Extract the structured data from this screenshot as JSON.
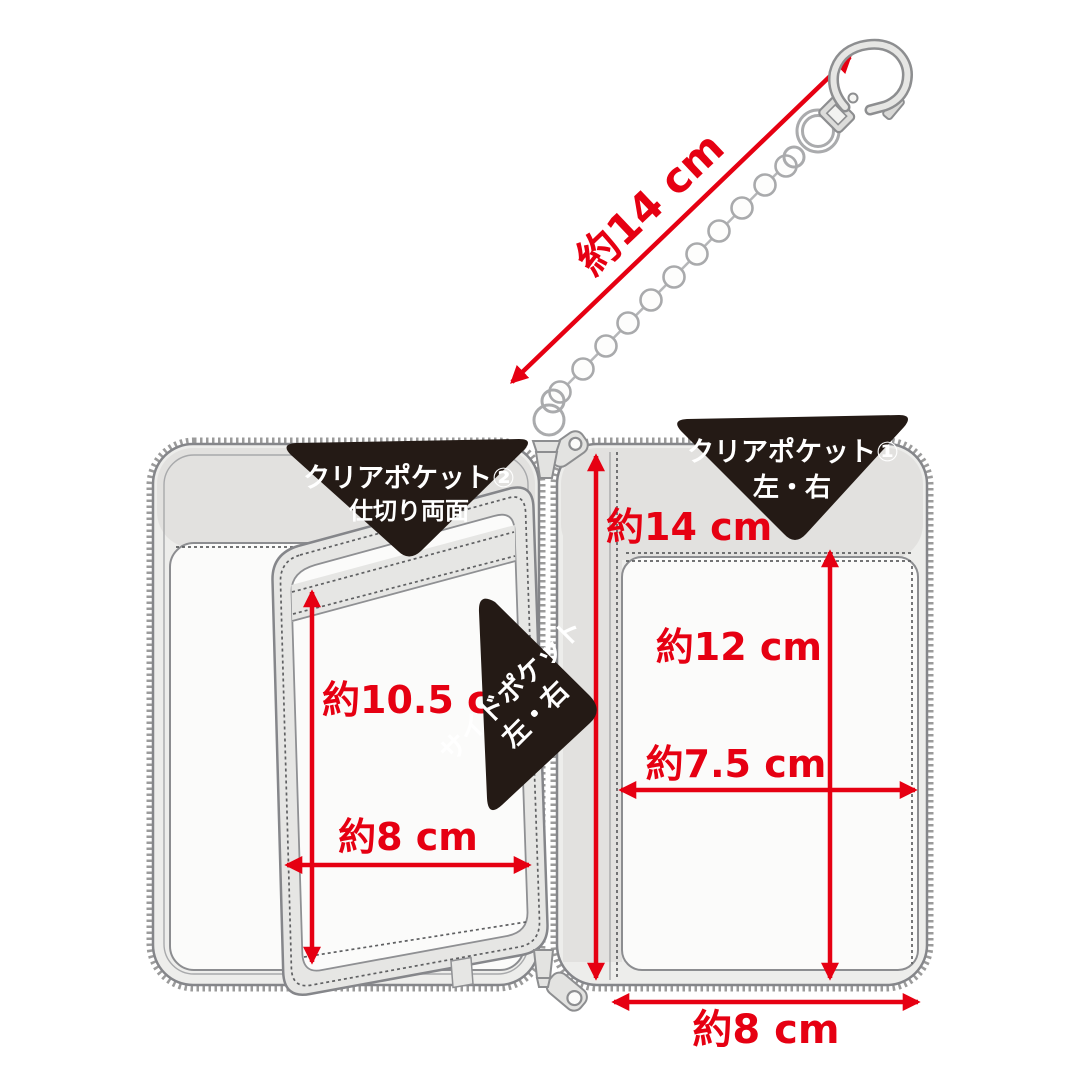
{
  "callouts": {
    "clear_pocket_2": {
      "line1": "クリアポケット②",
      "line2": "仕切り両面"
    },
    "clear_pocket_1": {
      "line1": "クリアポケット①",
      "line2": "左・右"
    },
    "side_pocket": {
      "line1": "サイドポケット",
      "line2": "左・右"
    }
  },
  "measurements": {
    "chain_length": "約14 cm",
    "case_height": "約14 cm",
    "clear_pocket1_height": "約12 cm",
    "clear_pocket1_width": "約7.5 cm",
    "case_bottom_width": "約8 cm",
    "divider_pocket_height": "約10.5 cm",
    "divider_pocket_width": "約8 cm"
  },
  "colors": {
    "measure_red": "#e60012",
    "callout_black": "#241a15",
    "metal_gray": "#aaabad"
  }
}
